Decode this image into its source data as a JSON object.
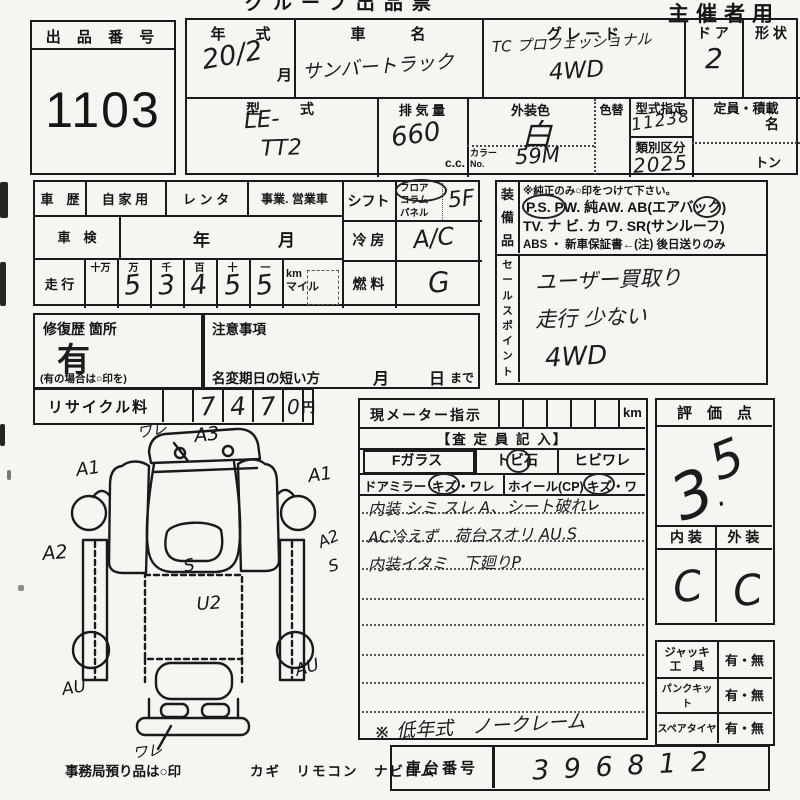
{
  "header": {
    "form_title": "グループ出品票",
    "corner_label": "主催者用"
  },
  "lot": {
    "label": "出 品 番 号",
    "number": "1103"
  },
  "vehicle": {
    "year_label": "年　　式",
    "year_value": "20/2",
    "month_suffix": "月",
    "name_label": "車　　　名",
    "name_value": "サンバートラック",
    "grade_label": "グ レ ー ド",
    "grade_line1": "TC プロフェッショナル",
    "grade_line2": "4WD",
    "door_label": "ド ア",
    "door_value": "2",
    "shape_label": "形 状",
    "model_label": "型　　式",
    "model_line1": "LE-",
    "model_line2": "TT2",
    "disp_label": "排 気 量",
    "disp_value": "660",
    "disp_unit": "c.c.",
    "body_color_label": "外装色",
    "body_color_value": "白",
    "color_change_label": "色替",
    "color_no_label": "カラー\nNo.",
    "color_no_value": "59M",
    "type_desig_label": "型式指定",
    "type_desig_value": "11238",
    "class_label": "類別区分",
    "class_value": "2025",
    "capacity_label": "定員・積載",
    "capacity_persons": "名",
    "capacity_tons": "トン"
  },
  "history": {
    "label": "車　歴",
    "opt1": "自 家 用",
    "opt2": "レ ン タ",
    "opt3": "事業. 営業車",
    "inspection_label": "車　検",
    "inspection_year": "年",
    "inspection_month": "月",
    "mileage_label": "走 行",
    "digit_headers": [
      "十万",
      "万",
      "千",
      "百",
      "十",
      "一"
    ],
    "digits": [
      "",
      "5",
      "3",
      "4",
      "5",
      "5"
    ],
    "unit": "km\nマイル"
  },
  "controls": {
    "shift_label": "シフト",
    "shift_opts": "フロア\nコラム\nパネル",
    "shift_value": "5F",
    "ac_label": "冷 房",
    "ac_value": "A/C",
    "fuel_label": "燃 料",
    "fuel_value": "G"
  },
  "equipment": {
    "label": "装\n備\n品",
    "note": "※純正のみ○印をつけて下さい。",
    "line1": "P.S.  PW. 純AW. AB(エアバック)",
    "line2": "TV. ナ ビ. カ ワ. SR(サンルーフ)",
    "line3": "ABS ・ 新車保証書←(注) 後日送りのみ"
  },
  "sales": {
    "label": "セ\nー\nル\nス\nポ\nイ\nン\nト",
    "line1": "ユーザー買取り",
    "line2": "走行 少ない",
    "line3": "4WD"
  },
  "repair": {
    "label": "修復歴 箇所",
    "value": "有",
    "note": "(有の場合は○印を)"
  },
  "caution": {
    "label": "注意事項",
    "deadline_label": "名変期日の短い方",
    "month": "月",
    "day": "日",
    "suffix": "まで"
  },
  "recycle": {
    "label": "リサイクル料",
    "d1": "7",
    "d2": "4",
    "d3": "7",
    "d4": "0",
    "unit": "円"
  },
  "meter": {
    "label": "現メーター指示",
    "unit": "km",
    "assessor": "【査 定 員 記 入】",
    "glass": "Fガラス",
    "stone": "トビ石",
    "crack": "ヒビワレ",
    "mirror": "ドアミラー",
    "mirror_dmg": "キズ・ワレ",
    "wheel": "ホイール(CP)",
    "wheel_dmg": "キズ・ワレ",
    "note1": "内装 シミ スレ A、シート破れ",
    "note2": "AC冷えず　荷台スオリ AU.S",
    "note3": "内装イタミ　下廻りP",
    "bottom_note": "※ 低年式　ノークレーム"
  },
  "score": {
    "label": "評　価　点",
    "value_int": "3",
    "value_dot": ".",
    "value_dec": "5",
    "interior_label": "内 装",
    "exterior_label": "外 装",
    "interior_value": "C",
    "exterior_value": "C"
  },
  "accessories": {
    "jack_label": "ジャッキ\n工　具",
    "jack_value": "有・無",
    "kit_label": "パンクキット",
    "kit_value": "有・無",
    "spare_label": "スペアタイヤ",
    "spare_value": "有・無"
  },
  "chassis": {
    "label": "車台番号",
    "value": "3 9 6 8 1 2"
  },
  "custody": {
    "label": "事務局預り品は○印",
    "items": "カギ　リモコン　ナビロム"
  },
  "diagram": {
    "ware_top": "ワレ",
    "a3": "A3",
    "a1_left": "A1",
    "a1_right": "A1",
    "a2_left": "A2",
    "a2_right": "A2",
    "s_right": "S",
    "s_center": "S",
    "u2": "U2",
    "au_left": "AU",
    "au_right": "AU",
    "ware_bottom": "ワレ"
  }
}
